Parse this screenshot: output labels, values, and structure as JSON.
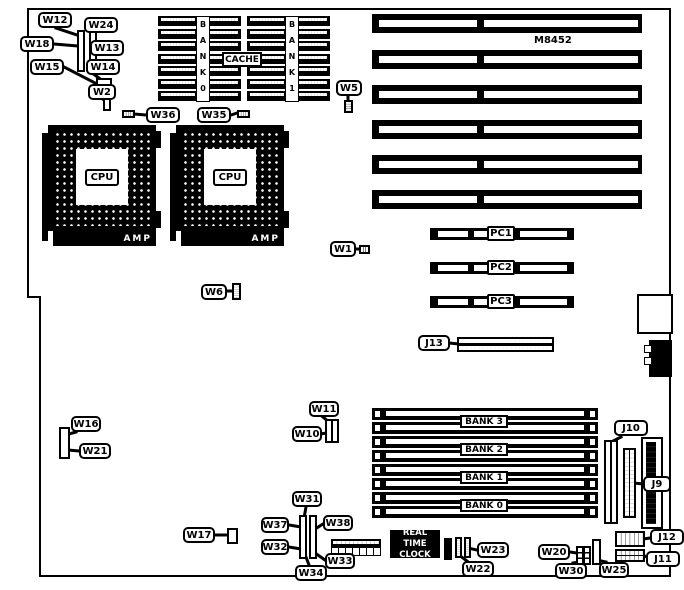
{
  "board": {
    "model": "M8452"
  },
  "labels": {
    "w1": "W1",
    "w2": "W2",
    "w5": "W5",
    "w6": "W6",
    "w10": "W10",
    "w11": "W11",
    "w12": "W12",
    "w13": "W13",
    "w14": "W14",
    "w15": "W15",
    "w16": "W16",
    "w17": "W17",
    "w18": "W18",
    "w20": "W20",
    "w21": "W21",
    "w22": "W22",
    "w23": "W23",
    "w24": "W24",
    "w25": "W25",
    "w30": "W30",
    "w31": "W31",
    "w32": "W32",
    "w33": "W33",
    "w34": "W34",
    "w35": "W35",
    "w36": "W36",
    "w37": "W37",
    "w38": "W38",
    "j6": "J6",
    "j9": "J9",
    "j10": "J10",
    "j11": "J11",
    "j12": "J12",
    "j13": "J13"
  },
  "cache": {
    "label": "CACHE",
    "bank0": "B\nA\nN\nK\n0",
    "bank1": "B\nA\nN\nK\n1"
  },
  "cpu": {
    "label": "CPU",
    "socket_brand": "AMP"
  },
  "memory": {
    "banks": [
      "BANK 3",
      "BANK 2",
      "BANK 1",
      "BANK 0"
    ]
  },
  "pc_slots": [
    "PC1",
    "PC2",
    "PC3"
  ],
  "rtc": {
    "label": "REAL TIME\nCLOCK"
  }
}
